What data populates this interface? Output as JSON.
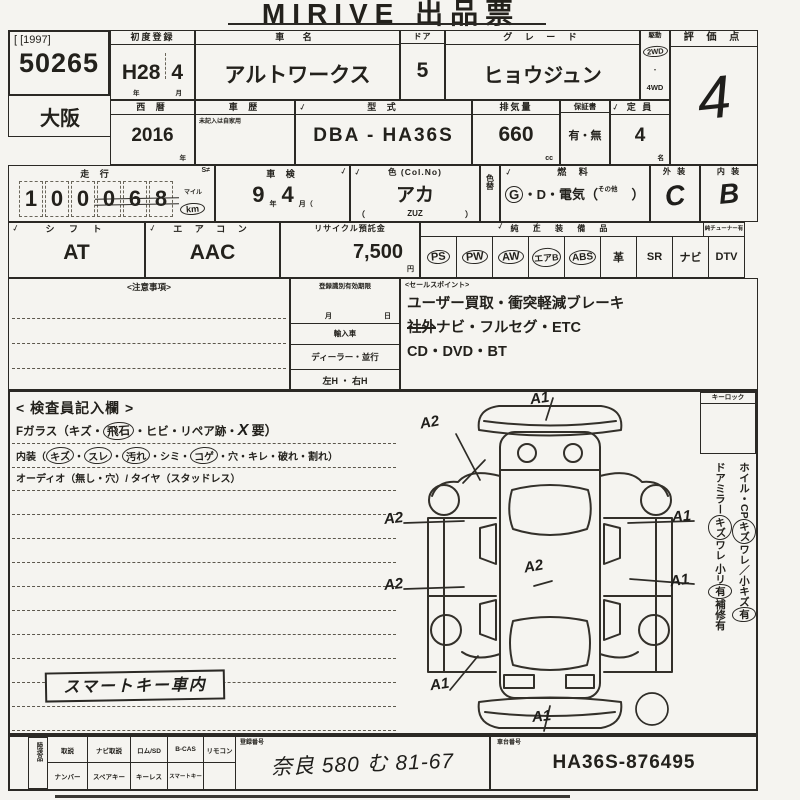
{
  "title": "MIRIVE 出品票",
  "corner": {
    "year_code": "[ [1997]",
    "auction_no": "50265",
    "region": "大阪"
  },
  "marks": {
    "check": "✓"
  },
  "row1": {
    "first_reg": {
      "label": "初度登録",
      "era": "H28",
      "month": "4",
      "year_suffix": "年",
      "month_suffix": "月"
    },
    "car_name": {
      "label": "車  名",
      "value": "アルトワークス"
    },
    "door": {
      "label": "ドア",
      "value": "5"
    },
    "grade": {
      "label": "グ レ ー ド",
      "value": "ヒョウジュン"
    },
    "drive": {
      "label": "駆動",
      "selected": "2WD",
      "dot": "・",
      "other": "4WD"
    },
    "score": {
      "label": "評 価 点",
      "value": "4"
    }
  },
  "row2": {
    "year": {
      "label": "西  暦",
      "value": "2016",
      "suffix": "年"
    },
    "history": {
      "label": "車  歴",
      "note": "未記入は自家用"
    },
    "model": {
      "label": "型  式",
      "value": "DBA - HA36S"
    },
    "displacement": {
      "label": "排気量",
      "value": "660",
      "suffix": "cc"
    },
    "warranty": {
      "label": "保証書",
      "value": "有・無"
    },
    "capacity": {
      "label": "定  員",
      "value": "4",
      "suffix": "名"
    }
  },
  "row3": {
    "mileage": {
      "label": "走  行",
      "digits": [
        "1",
        "0",
        "0",
        "0",
        "6",
        "8"
      ],
      "mile_label": "マイル",
      "km_label": "km",
      "tag": "S≠"
    },
    "inspection": {
      "label": "車  検",
      "year": "9",
      "year_suffix": "年",
      "month": "4",
      "month_suffix": "月（"
    },
    "color": {
      "label": "色 (Col.No)",
      "value": "アカ",
      "code_open": "（",
      "code": "ZUZ",
      "code_close": "）"
    },
    "color_change": {
      "label": "色替"
    },
    "fuel": {
      "label": "燃  料",
      "gas": "G",
      "rest": "・D・電気（",
      "other": "その他",
      "close": "）"
    },
    "exterior": {
      "label": "外 装",
      "value": "C"
    },
    "interior": {
      "label": "内 装",
      "value": "B"
    }
  },
  "row4": {
    "shift": {
      "label": "シ フ ト",
      "value": "AT"
    },
    "aircon": {
      "label": "エ ア コ ン",
      "value": "AAC"
    },
    "recycle": {
      "label": "リサイクル預託金",
      "value": "7,500",
      "suffix": "円"
    },
    "equipment": {
      "label": "純 正 装 備 品",
      "sub_label": "純チューナー有",
      "items": [
        {
          "text": "PS",
          "circled": true
        },
        {
          "text": "PW",
          "circled": true
        },
        {
          "text": "AW",
          "circled": true
        },
        {
          "text": "エアB",
          "circled": true
        },
        {
          "text": "ABS",
          "circled": true
        },
        {
          "text": "革",
          "circled": false
        },
        {
          "text": "SR",
          "circled": false
        },
        {
          "text": "ナビ",
          "circled": false
        },
        {
          "text": "DTV",
          "circled": false
        }
      ]
    }
  },
  "notes_box": {
    "label": "<注意事項>"
  },
  "reg_box": {
    "expiry_label": "登録識別有効期限",
    "month": "月",
    "day": "日",
    "import_label": "輸入車",
    "dealer_label": "ディーラー・並行",
    "handle_label": "左H ・ 右H"
  },
  "sales": {
    "label": "<セールスポイント>",
    "line1": "ユーザー買取・衝突軽減ブレーキ",
    "line2_strike": "社外",
    "line2_rest": "ナビ・フルセグ・ETC",
    "line3": "CD・DVD・BT"
  },
  "inspector": {
    "title": "< 検査員記入欄 >",
    "fglass_pre": "Fガラス（キズ・",
    "fglass_circled": "飛石",
    "fglass_mid": "・ヒビ・リペア跡・",
    "fglass_x": "X",
    "fglass_end": "要）",
    "interior_pre": "内装（",
    "i_c1": "キズ",
    "i_s1": "・",
    "i_c2": "スレ",
    "i_s2": "・",
    "i_c3": "汚れ",
    "i_s3": "・シミ・",
    "i_c4": "コゲ",
    "i_end": "・穴・キレ・破れ・割れ）",
    "audio_line": "オーディオ（無し・穴）/ タイヤ（スタッドレス）",
    "stamp": "スマートキー車内",
    "keylock": "キーロック",
    "side1_pre": "ホイル・CP",
    "side1_c1": "キズ",
    "side1_mid": "ワレ／小キズ",
    "side1_c2": "有",
    "side2_pre": "ドアミラー",
    "side2_c1": "キズ",
    "side2_mid": "ワレ 小リ",
    "side2_c2": "有",
    "side2_end": "補修有"
  },
  "diagram": {
    "marks": [
      {
        "text": "A1"
      },
      {
        "text": "A2"
      },
      {
        "text": "A2"
      },
      {
        "text": "A2"
      },
      {
        "text": "A2"
      },
      {
        "text": "A1"
      },
      {
        "text": "A1"
      },
      {
        "text": "A1"
      },
      {
        "text": "A1"
      }
    ]
  },
  "bottom": {
    "vertical_label": "陸送品",
    "cells_top": [
      "取説",
      "ナビ取説",
      "ロム/SD",
      "B-CAS",
      "リモコン"
    ],
    "cells_bottom": [
      "ナンバー",
      "スペアキー",
      "キーレス",
      "スマートキー",
      ""
    ],
    "reg_no": {
      "label": "登録番号",
      "value": "奈良 580  む  81-67"
    },
    "chassis": {
      "label": "車台番号",
      "value": "HA36S-876495"
    }
  }
}
